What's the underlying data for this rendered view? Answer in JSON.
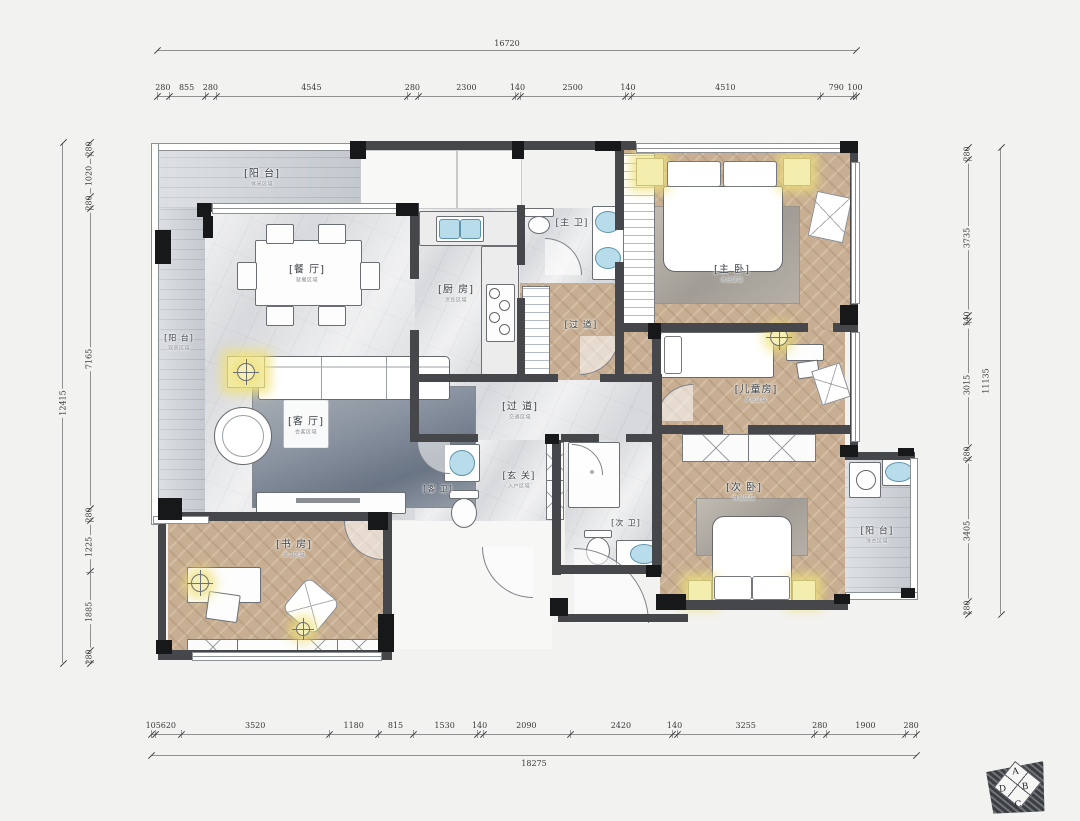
{
  "dimensions": {
    "top": {
      "total": "16720",
      "segments": [
        "280",
        "855",
        "280",
        "4545",
        "280",
        "2300",
        "140",
        "2500",
        "140",
        "4510",
        "790",
        "100"
      ]
    },
    "bottom": {
      "total": "18275",
      "segments": [
        "105",
        "620",
        "3520",
        "1180",
        "815",
        "1530",
        "140",
        "2090",
        "2420",
        "140",
        "3255",
        "280",
        "1900",
        "280"
      ]
    },
    "left": {
      "total": "12415",
      "segments": [
        "280",
        "1020",
        "280",
        "7165",
        "280",
        "1225",
        "1885",
        "280"
      ]
    },
    "right": {
      "total": "11135",
      "segments": [
        "280",
        "3735",
        "140",
        "3015",
        "280",
        "3405",
        "280"
      ]
    }
  },
  "rooms": {
    "balcony_top": {
      "name": "[阳 台]",
      "subtitle": "休闲区域"
    },
    "balcony_left": {
      "name": "[阳 台]",
      "subtitle": "观景区域"
    },
    "dining": {
      "name": "[餐 厅]",
      "subtitle": "就餐区域"
    },
    "kitchen": {
      "name": "[厨 房]",
      "subtitle": "烹饪区域"
    },
    "master_bath": {
      "name": "[主 卫]",
      "subtitle": ""
    },
    "hallway_master": {
      "name": "[过 道]",
      "subtitle": ""
    },
    "master_bedroom": {
      "name": "[主 卧]",
      "subtitle": "休息区域"
    },
    "kids_room": {
      "name": "[儿童房]",
      "subtitle": "休息区域"
    },
    "corridor": {
      "name": "[过 道]",
      "subtitle": "交通区域"
    },
    "living": {
      "name": "[客 厅]",
      "subtitle": "会客区域"
    },
    "guest_bath": {
      "name": "[客 卫]",
      "subtitle": ""
    },
    "entry": {
      "name": "[玄 关]",
      "subtitle": "入户区域"
    },
    "second_bath": {
      "name": "[次 卫]",
      "subtitle": ""
    },
    "second_bedroom": {
      "name": "[次 卧]",
      "subtitle": "休息区域"
    },
    "study": {
      "name": "[书 房]",
      "subtitle": "学习区域"
    },
    "balcony_right": {
      "name": "[阳 台]",
      "subtitle": "洗衣区域"
    }
  },
  "compass": {
    "a": "A",
    "b": "B",
    "c": "C",
    "d": "D"
  },
  "colors": {
    "wall": "#45474b",
    "wood_floor": "#c8af93",
    "marble_floor": "#e1e2e4",
    "deck_floor": "#ccd0d5",
    "lamp_glow": "#f3edae",
    "sink_blue": "#b8dcea"
  }
}
